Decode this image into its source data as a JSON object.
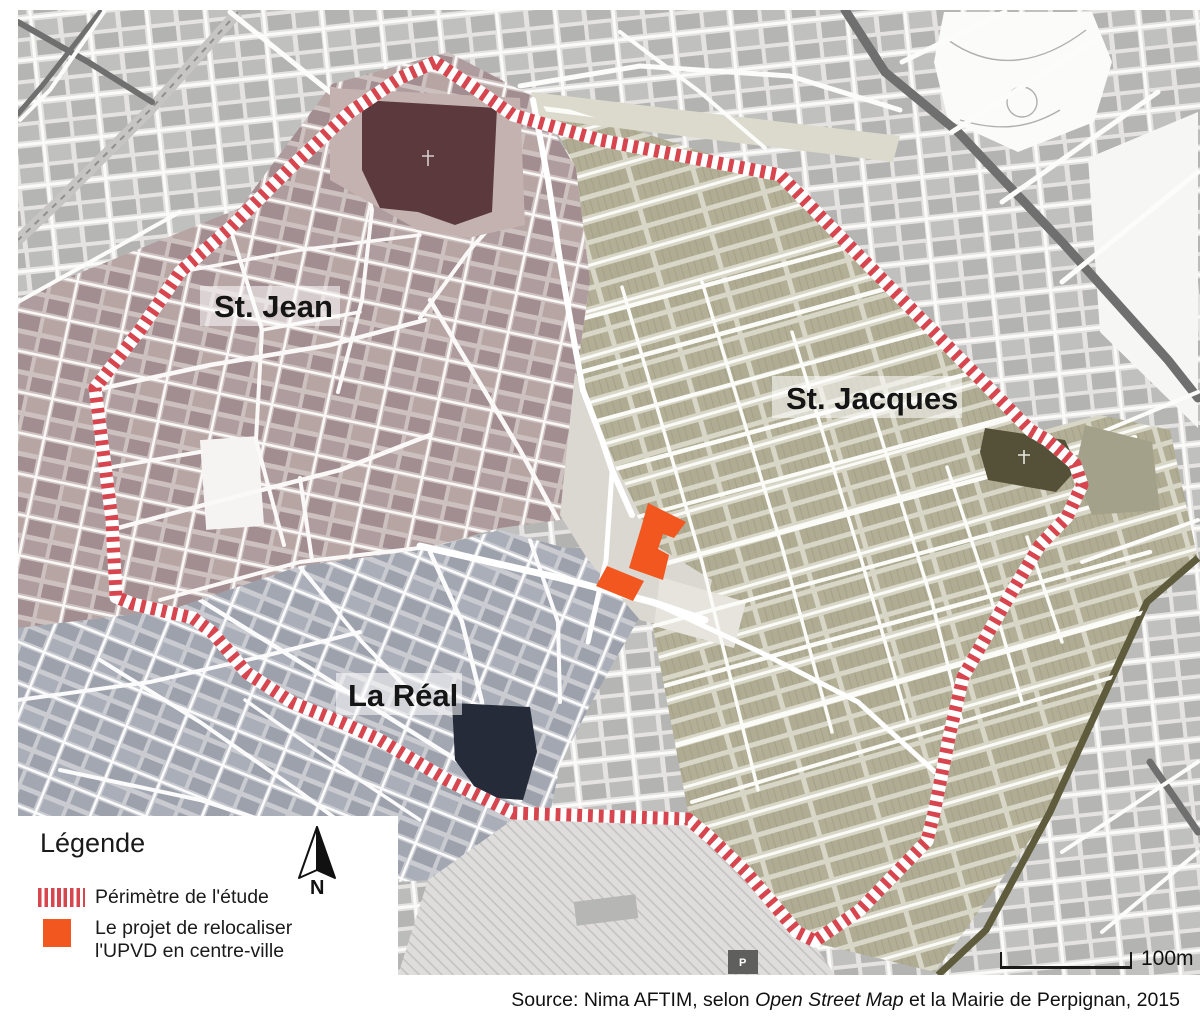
{
  "map": {
    "districts": [
      {
        "id": "st-jean",
        "label": "St. Jean",
        "building_color": "#A38E91",
        "base_color": "#CDC1BF"
      },
      {
        "id": "st-jacques",
        "label": "St. Jacques",
        "building_color": "#AEAB91",
        "base_color": "#D8D6C6"
      },
      {
        "id": "la-real",
        "label": "La Réal",
        "building_color": "#9CA1AC",
        "base_color": "#C9CBD1"
      }
    ],
    "parking_label": "P"
  },
  "legend": {
    "title": "Légende",
    "items": [
      {
        "symbol": "red-striped-line",
        "label": "Périmètre de l'étude"
      },
      {
        "symbol": "orange-square",
        "label": "Le projet de relocaliser l'UPVD en centre-ville",
        "line1": "Le projet de relocaliser",
        "line2": "l'UPVD en centre-ville"
      }
    ]
  },
  "north_arrow": {
    "label": "N"
  },
  "scale_bar": {
    "label": "100m"
  },
  "source": {
    "prefix": "Source: Nima AFTIM, selon ",
    "italic": "Open Street Map",
    "suffix": " et la Mairie de Perpignan, 2015"
  },
  "colors": {
    "perimeter_red": "#D7454E",
    "project_orange": "#F2571F",
    "cathedral_dark": "#5B393C",
    "la_real_church_navy": "#262B3A",
    "st_jacques_church_olive": "#545138",
    "outside_building_gray": "#B6B6B4",
    "road_dark_gray": "#6F6F6F",
    "road_olive": "#5E5C3C"
  }
}
